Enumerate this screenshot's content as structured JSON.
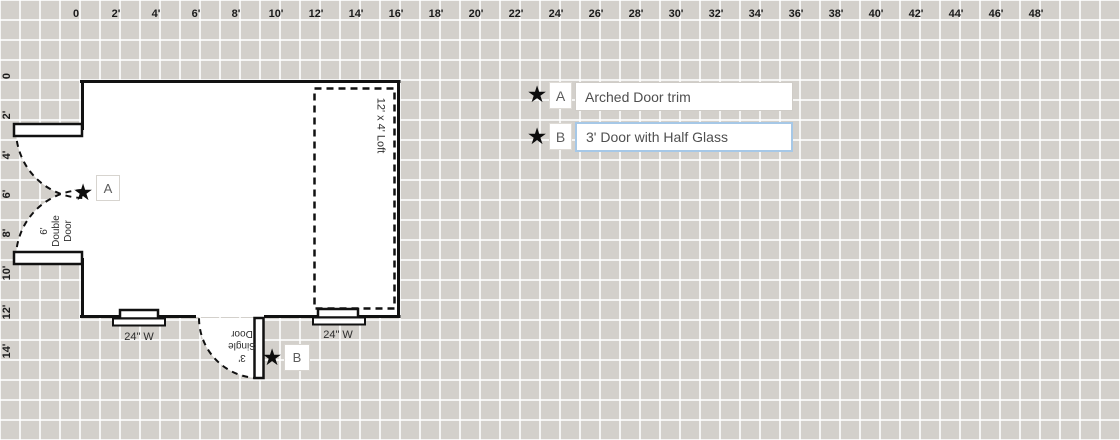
{
  "rulers": {
    "top": [
      "0",
      "2'",
      "4'",
      "6'",
      "8'",
      "10'",
      "12'",
      "14'",
      "16'",
      "18'",
      "20'",
      "22'",
      "24'",
      "26'",
      "28'",
      "30'",
      "32'",
      "34'",
      "36'",
      "38'",
      "40'",
      "42'",
      "44'",
      "46'",
      "48'"
    ],
    "left": [
      "0",
      "2'",
      "4'",
      "6'",
      "8'",
      "10'",
      "12'",
      "14'"
    ]
  },
  "plan": {
    "double_door_label": "6'\nDouble\nDoor",
    "single_door_label": "3'\nSingle\nDoor",
    "loft_label": "12' x 4' Loft",
    "window_left_label": "24\" W",
    "window_right_label": "24\" W"
  },
  "legend": {
    "items": [
      {
        "letter": "A",
        "description": "Arched Door trim"
      },
      {
        "letter": "B",
        "description": "3' Door with Half Glass"
      }
    ]
  },
  "icons": {
    "star": "★"
  },
  "colors": {
    "background": "#d3d0cb",
    "grid_line": "#edebe8",
    "wall": "#111111",
    "focused_input_border": "#a6c8e7"
  }
}
